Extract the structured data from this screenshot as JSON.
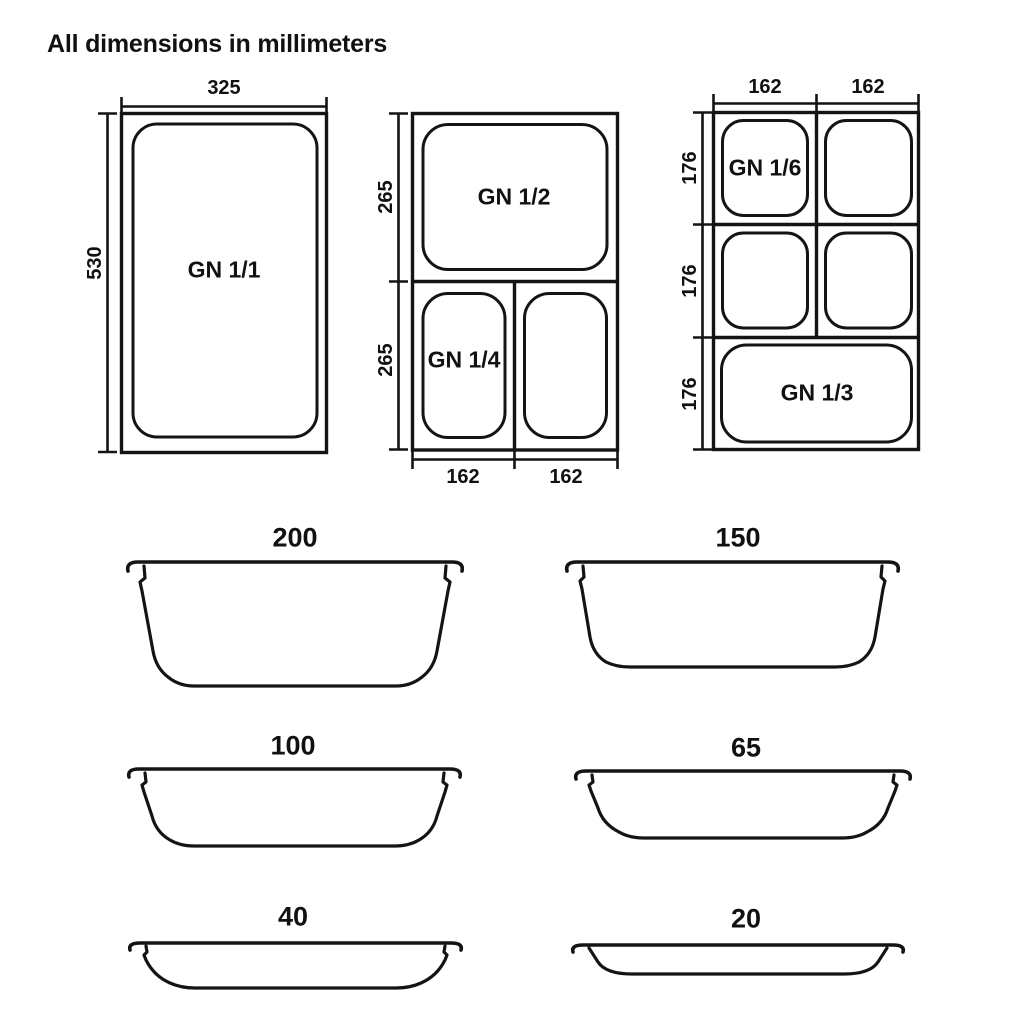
{
  "title": "All dimensions in millimeters",
  "top_views": {
    "gn11": {
      "label": "GN 1/1",
      "dim_width": "325",
      "dim_height": "530"
    },
    "gn12_gn14": {
      "label_top": "GN 1/2",
      "label_bottom_left": "GN 1/4",
      "dim_height_top": "265",
      "dim_height_bottom": "265",
      "dim_width_left": "162",
      "dim_width_right": "162"
    },
    "gn16_gn13": {
      "label_top_left": "GN 1/6",
      "label_bottom": "GN 1/3",
      "dim_width_left": "162",
      "dim_width_right": "162",
      "dim_height_top": "176",
      "dim_height_middle": "176",
      "dim_height_bottom": "176"
    }
  },
  "side_views": {
    "depths": {
      "d200": "200",
      "d150": "150",
      "d100": "100",
      "d65": "65",
      "d40": "40",
      "d20": "20"
    }
  }
}
